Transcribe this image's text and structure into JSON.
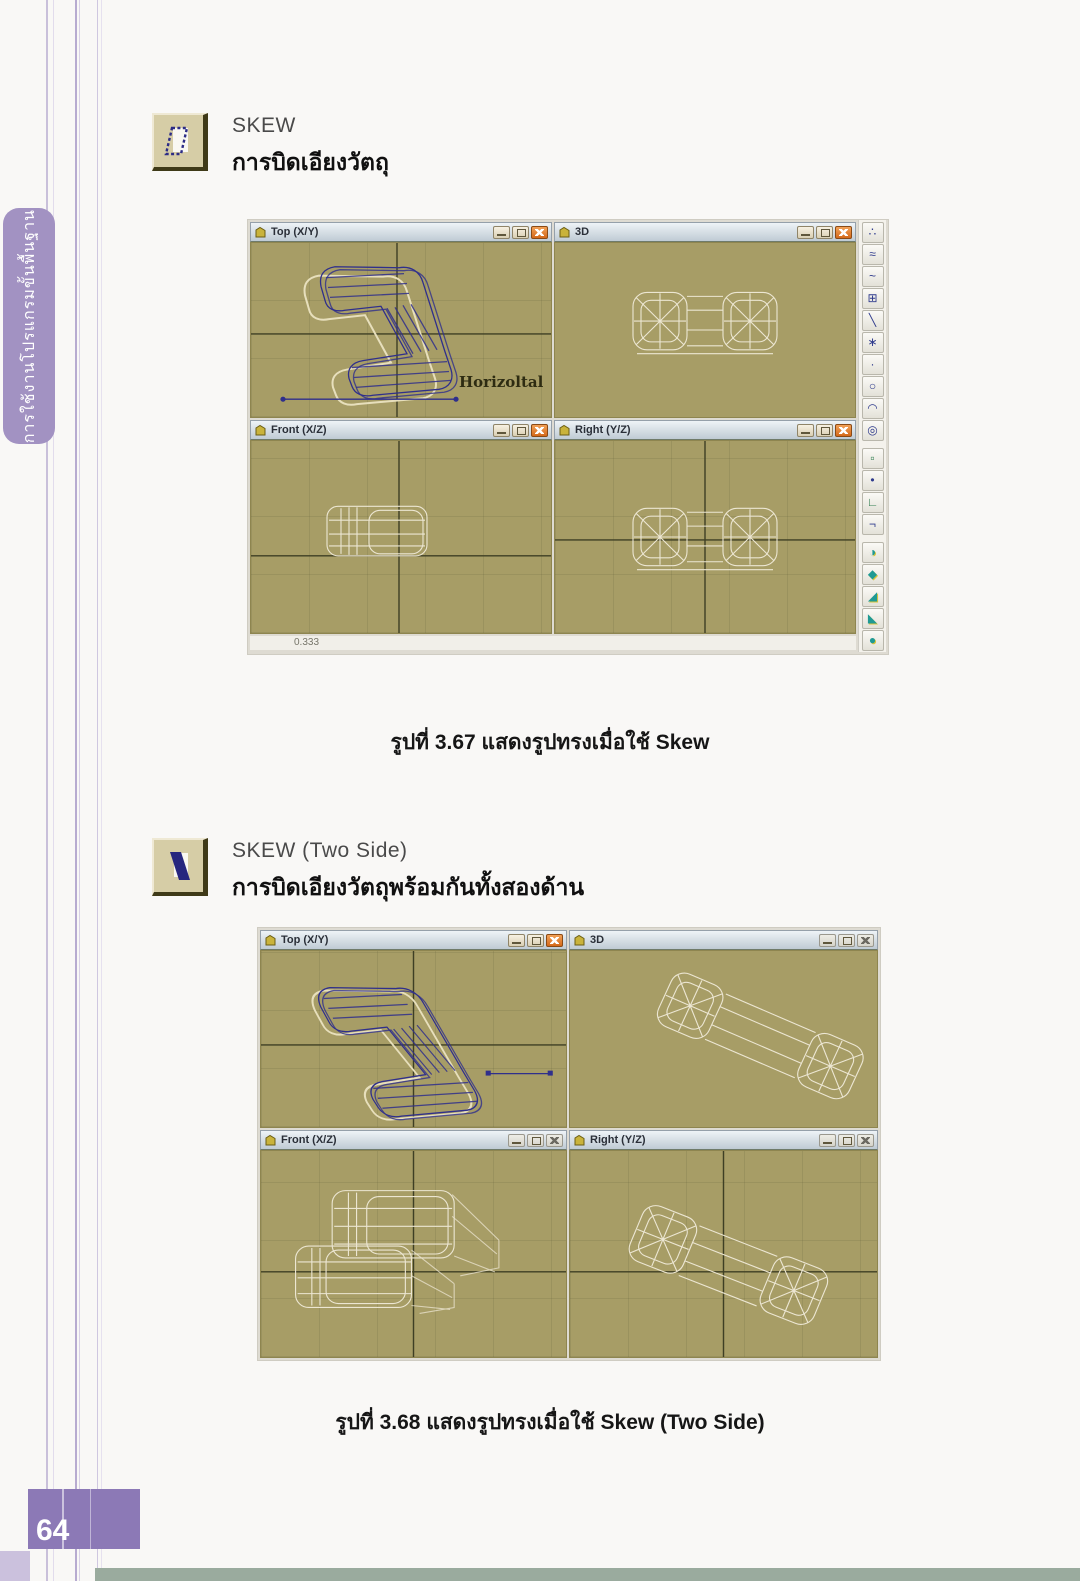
{
  "page": {
    "sidebar_label": "การใช้งานโปรแกรมขั้นพื้นฐาน",
    "page_number": "64"
  },
  "sections": [
    {
      "title": "SKEW",
      "subtitle": "การบิดเอียงวัตถุ",
      "caption": "รูปที่ 3.67 แสดงรูปทรงเมื่อใช้ Skew",
      "figure": {
        "viewports": [
          {
            "label": "Top (X/Y)"
          },
          {
            "label": "3D"
          },
          {
            "label": "Front (X/Z)"
          },
          {
            "label": "Right (Y/Z)"
          }
        ],
        "annotation": "Horizoltal",
        "status": "0.333"
      }
    },
    {
      "title": "SKEW (Two Side)",
      "subtitle": "การบิดเอียงวัตถุพร้อมกันทั้งสองด้าน",
      "caption": "รูปที่ 3.68 แสดงรูปทรงเมื่อใช้ Skew (Two Side)",
      "figure": {
        "viewports": [
          {
            "label": "Top (X/Y)"
          },
          {
            "label": "3D"
          },
          {
            "label": "Front (X/Z)"
          },
          {
            "label": "Right (Y/Z)"
          }
        ]
      }
    }
  ],
  "toolbar": {
    "buttons": [
      {
        "name": "scatter-tool",
        "glyph": "∴"
      },
      {
        "name": "wave-tool",
        "glyph": "≈"
      },
      {
        "name": "spline-tool",
        "glyph": "~"
      },
      {
        "name": "lattice-tool",
        "glyph": "⊞"
      },
      {
        "name": "line-tool",
        "glyph": "╲"
      },
      {
        "name": "star-tool",
        "glyph": "∗"
      },
      {
        "name": "point-tool",
        "glyph": "·"
      },
      {
        "name": "circle-tool",
        "glyph": "○"
      },
      {
        "name": "arc-tool",
        "glyph": "◠"
      },
      {
        "name": "ellipse-tool",
        "glyph": "◎"
      },
      {
        "name": "window-tool",
        "glyph": "▫"
      },
      {
        "name": "dot-tool",
        "glyph": "•"
      },
      {
        "name": "corner-tool",
        "glyph": "∟"
      },
      {
        "name": "angle-tool",
        "glyph": "¬"
      },
      {
        "name": "bend-modifier",
        "glyph": "◑"
      },
      {
        "name": "taper-modifier",
        "glyph": "◆"
      },
      {
        "name": "twist-modifier",
        "glyph": "◢"
      },
      {
        "name": "skew-modifier",
        "glyph": "◣"
      },
      {
        "name": "stretch-modifier",
        "glyph": "●"
      }
    ]
  },
  "colors": {
    "accent_purple": "#a292c2",
    "page_number_bg": "#8c79b6",
    "viewport_bg": "#a79d66",
    "axis_line": "#3e3f24",
    "wireframe_blue": "#2f2f8c",
    "wireframe_ghost": "#e7dfbc",
    "wireframe_white": "#ece6d2",
    "titlebar_top": "#eef3f7",
    "titlebar_bottom": "#bfcbd4",
    "close_button": "#d4691a"
  }
}
